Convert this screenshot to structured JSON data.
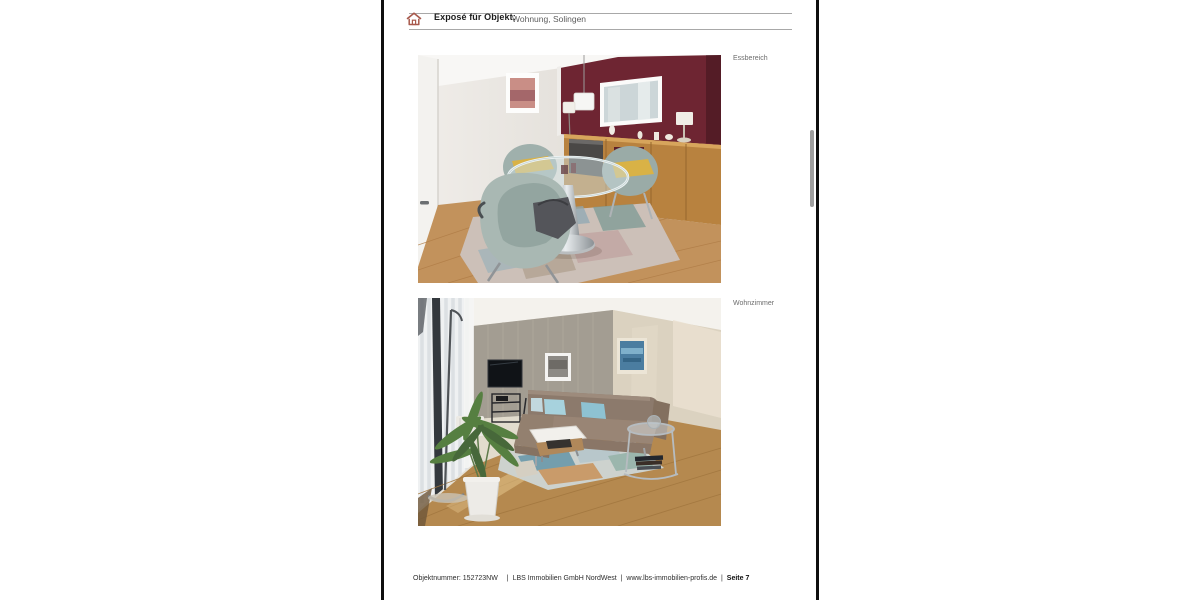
{
  "page": {
    "header": {
      "title": "Exposé für Objekt:",
      "object": "Wohnung, Solingen"
    },
    "photos": [
      {
        "label": "Essbereich"
      },
      {
        "label": "Wohnzimmer"
      }
    ],
    "footer": {
      "objektnummer": "Objektnummer: 152723NW",
      "separator": "|",
      "company": "LBS Immobilien GmbH NordWest",
      "website": "www.lbs-immobilien-profis.de",
      "page": "Seite 7"
    },
    "colors": {
      "accent_red": "#a8594c",
      "page_border": "#0e0e0e",
      "rule_gray": "#a8a8a8",
      "scrollbar_gray": "#9e9e9e",
      "label_gray": "#6d6d6d",
      "footer_text": "#2d2d2d"
    },
    "icons": {
      "home": "house-outline"
    }
  }
}
